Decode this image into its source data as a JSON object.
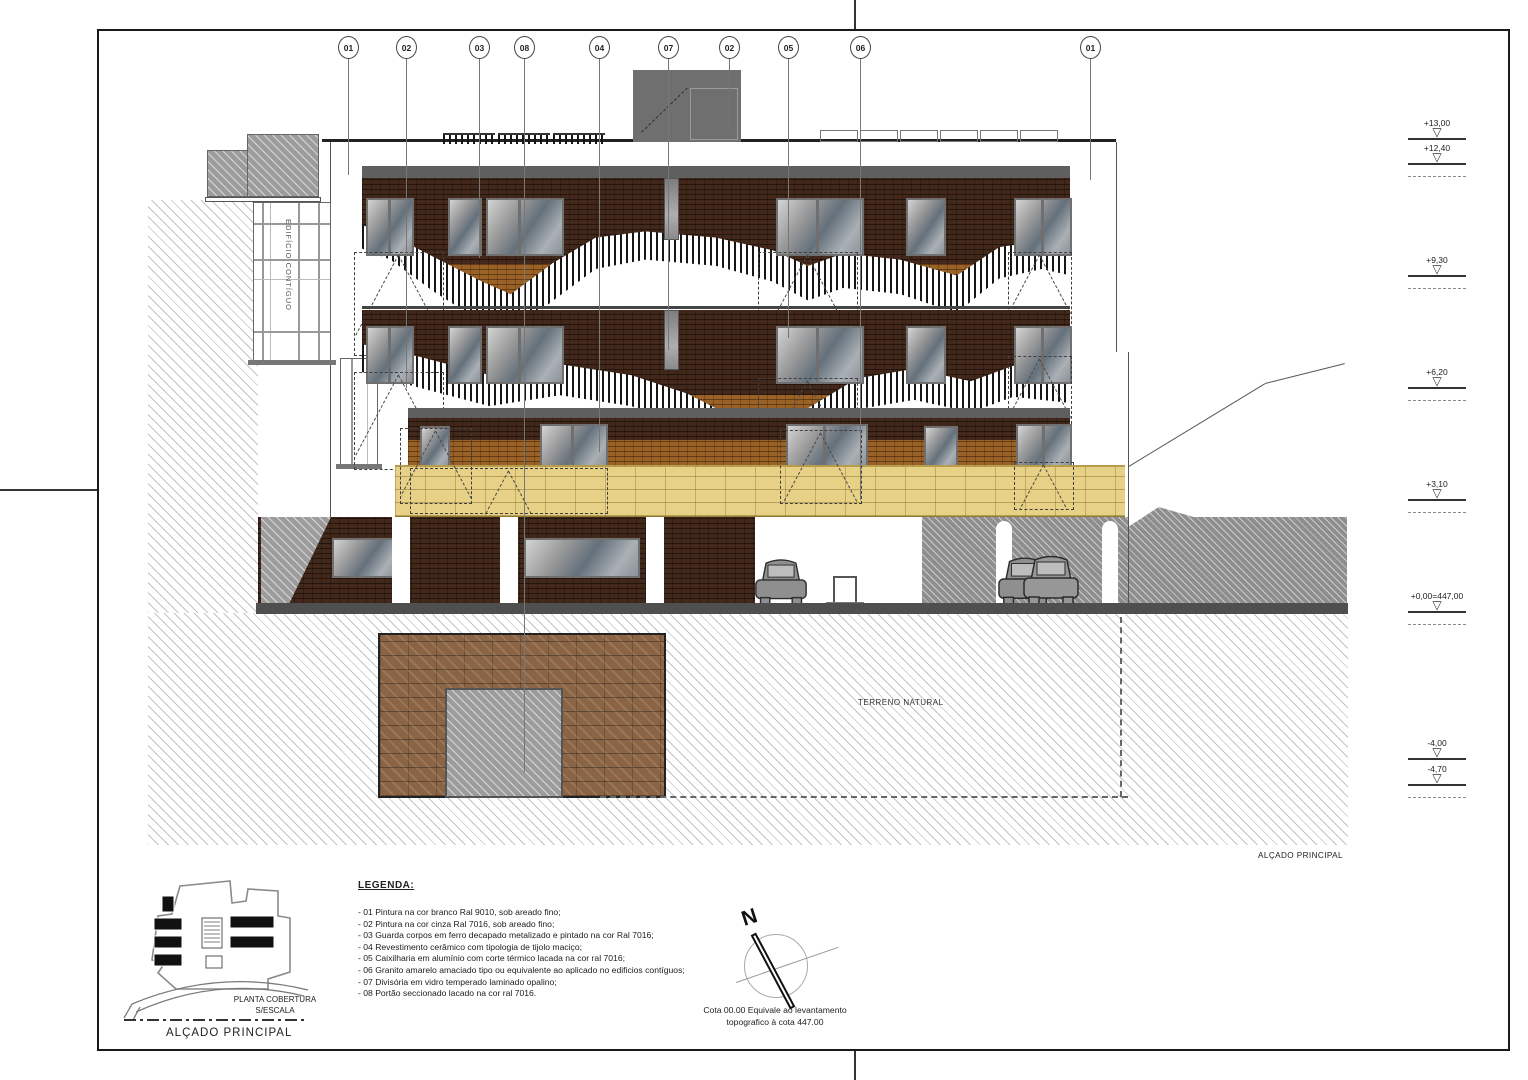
{
  "callouts": [
    "01",
    "02",
    "03",
    "08",
    "04",
    "07",
    "02",
    "05",
    "06",
    "01"
  ],
  "levels": [
    "+13,00",
    "+12,40",
    "+9,30",
    "+6,20",
    "+3,10",
    "+0,00=447,00",
    "-4,00",
    "-4,70"
  ],
  "legend": {
    "title": "LEGENDA:",
    "items": [
      "- 01 Pintura na cor branco Ral 9010, sob areado fino;",
      "- 02 Pintura na cor cinza Ral 7016, sob areado fino;",
      "- 03 Guarda corpos em ferro decapado metalizado e pintado na cor Ral 7016;",
      "- 04 Revestimento cerâmico com tipologia de tijolo maciço;",
      "- 05 Caixilharia em alumínio com corte térmico lacada na cor ral 7016;",
      "- 06 Granito amarelo amaciado tipo ou equivalente ao aplicado no edificios contíguos;",
      "- 07 Divisória em vidro temperado laminado opalino;",
      "- 08 Portão seccionado lacado na cor ral 7016."
    ]
  },
  "labels": {
    "adjacent": "EDIFÍCIO CONTÍGUO",
    "terreno": "TERRENO NATURAL",
    "roofplan_line1": "PLANTA COBERTURA",
    "roofplan_line2": "S/ESCALA",
    "roofplan_caption": "ALÇADO PRINCIPAL",
    "drawing_caption": "ALÇADO PRINCIPAL",
    "north": "N",
    "note_line1": "Cota 00.00 Equivale ao levantamento",
    "note_line2": "topografico à cota 447.00"
  },
  "colors": {
    "brick_dark": "#42281a",
    "brick_light": "#9a6226",
    "granite_yellow": "#e7d187",
    "slab_gray": "#5f5f5f",
    "roof_gray": "#6f6f6f",
    "paper": "#ffffff"
  }
}
